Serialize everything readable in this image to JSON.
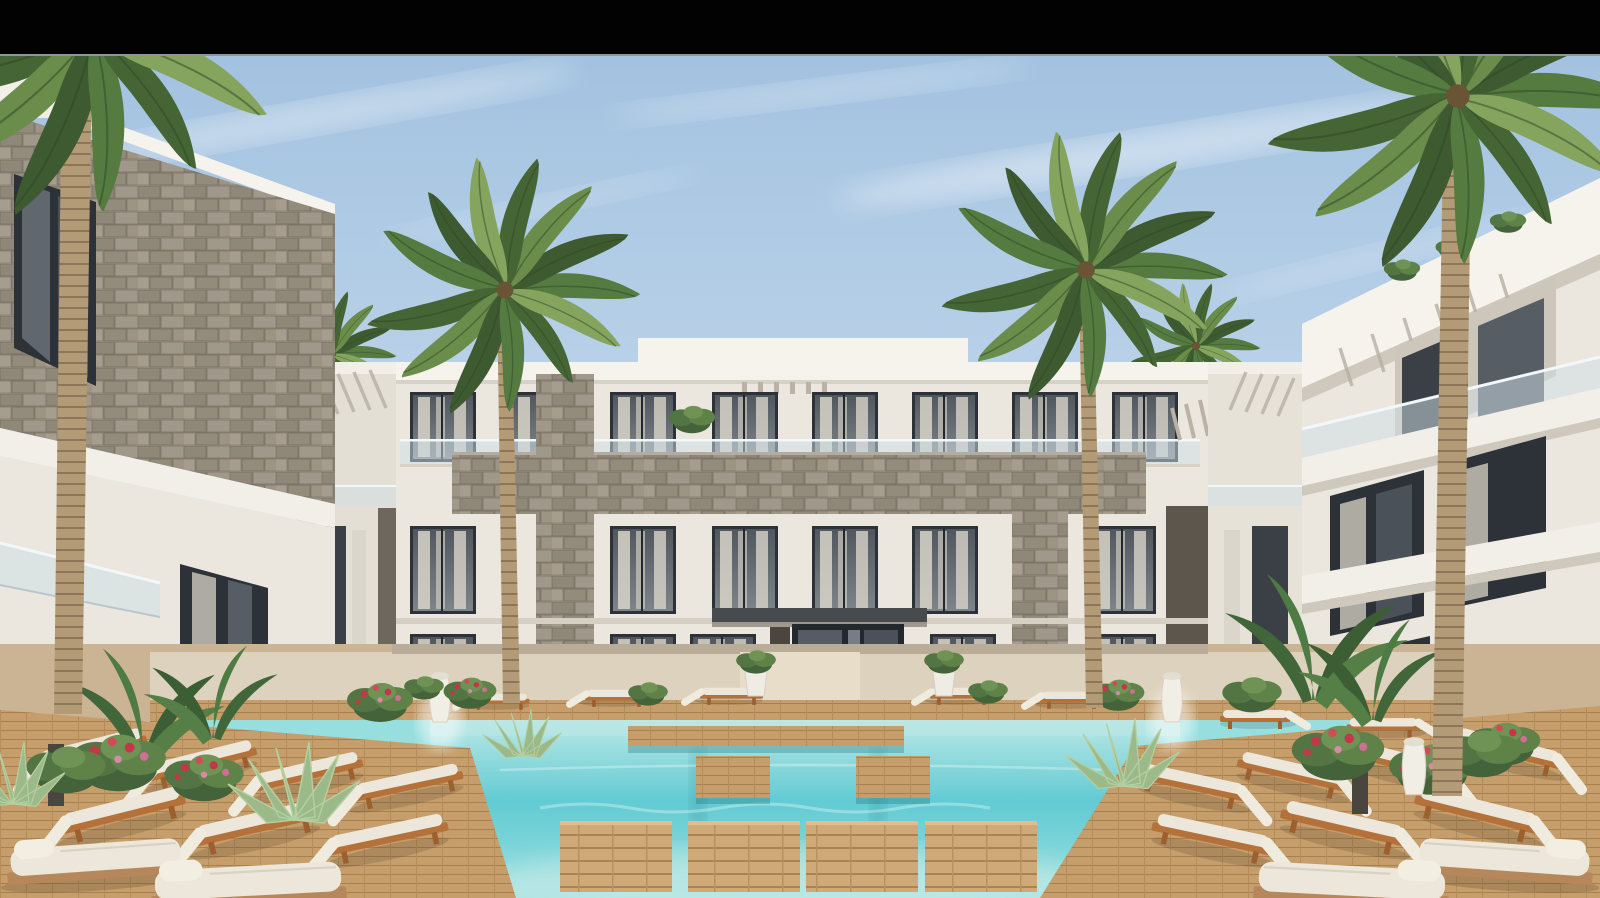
{
  "meta": {
    "kind": "architectural-exterior-render",
    "description": "Photorealistic 3D visualization of a U-shaped modern white residential complex around a turquoise swimming pool with wooden decks, sun loungers and tall palm trees under a hazy blue sky; black letterbox bar across the top of the frame.",
    "time_of_day": "daytime"
  },
  "letterbox": {
    "bar_color": "#020202",
    "separator_color": "#8d969c"
  },
  "palette": {
    "sky_top": "#a3c2e0",
    "sky_mid": "#c3d8ec",
    "sky_low": "#e0eaf3",
    "cloud": "#f4f8fb",
    "facade_white": "#ebe7de",
    "facade_bright": "#f6f3ec",
    "facade_shadow": "#d7d2c7",
    "stone": "#98907f",
    "stone_dark": "#6e675e",
    "glass_dark": "#2c3237",
    "glass_mid": "#5a6168",
    "curtain": "#d8d3c9",
    "railing_glass": "#cfe0e8",
    "pool_pale": "#bce8e6",
    "pool_deep": "#62cbd3",
    "pool_light": "#97dedf",
    "wood_deck": "#c59e6b",
    "wood_dark": "#a8804f",
    "wood_frame": "#b5713a",
    "cushion_white": "#ece7da",
    "palm_green": "#557b41",
    "palm_green_dark": "#3d5a31",
    "palm_green_light": "#85a55e",
    "trunk": "#b29b76",
    "trunk_dark": "#8d7657",
    "flower_red": "#c23848",
    "flower_pink": "#cf6f93",
    "planter_white": "#efece3"
  },
  "scene": {
    "buildings": {
      "center_block": "three-storey white apartment facade with glass balustrades, sheer-curtained windows, grey stone-clad balcony band and recessed entrance",
      "left_block": "foreground white wing with grey stone-clad upper band, dark framed windows and glass balcony",
      "right_block": "foreground white wing with cantilevered balconies, glass railings and rooftop planting"
    },
    "pool": "turquoise pool with floating wooden step platforms and a timber cross-walkway",
    "palms": 4,
    "sunbeds_left": 7,
    "sunbeds_right": 7,
    "back_row_loungers": 7,
    "large_daybeds": 4,
    "planting": "banana plants, agaves, green shrubs with red and pink flowers, white planters and vases"
  }
}
